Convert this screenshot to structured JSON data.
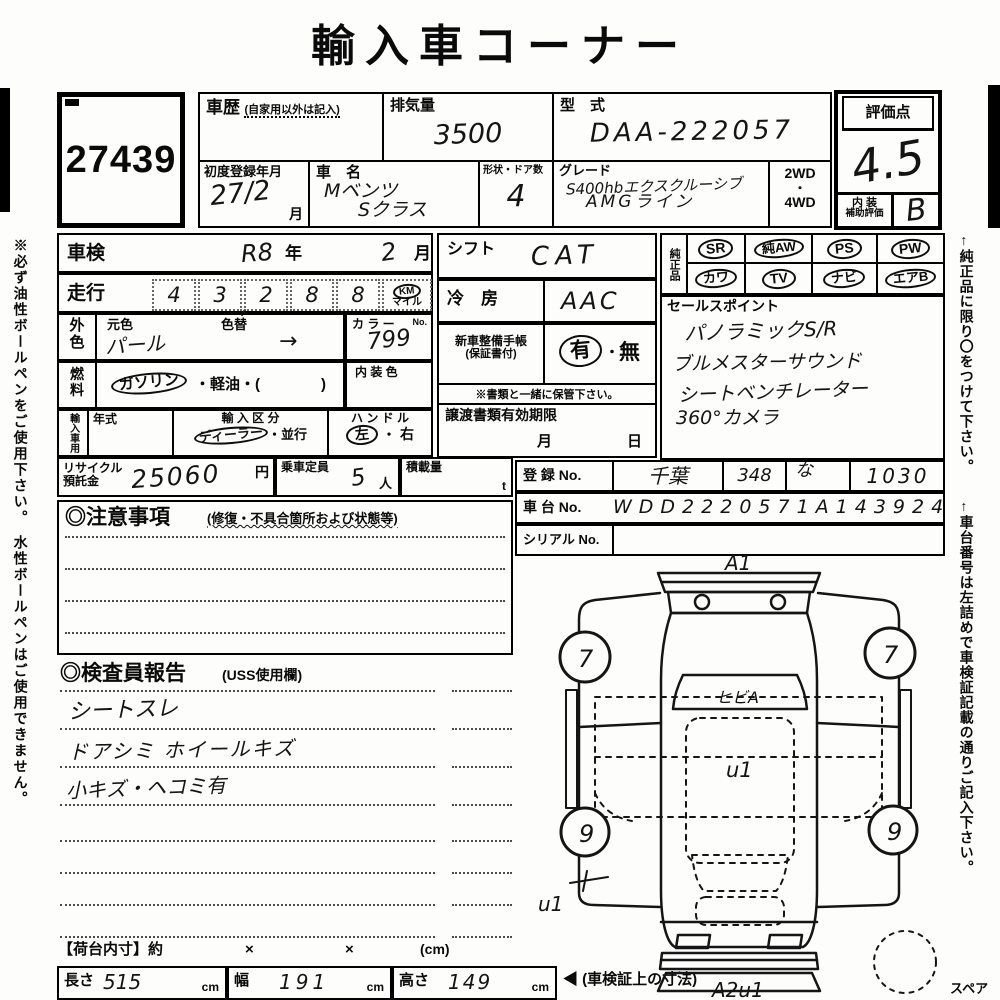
{
  "title": "輸入車コーナー",
  "margin": {
    "left_note": "※必ず油性ボールペンをご使用下さい。　水性ボールペンはご使用できません。",
    "right_note1": "←純正品に限り〇をつけて下さい。",
    "right_note2": "←車台番号は左詰めで車検証記載の通りご記入下さい。",
    "spare": "スペア"
  },
  "lot": {
    "number": "27439"
  },
  "top": {
    "history": {
      "label": "車歴",
      "note": "(自家用以外は記入)"
    },
    "displacement": {
      "label": "排気量",
      "value": "3500"
    },
    "model": {
      "label": "型　式",
      "value": "DAA-222057"
    },
    "first_reg": {
      "label": "初度登録年月",
      "value": "27/2",
      "unit": "月"
    },
    "name": {
      "label": "車　名",
      "line1": "Mベンツ",
      "line2": "Sクラス"
    },
    "doors": {
      "label": "形状・ドア数",
      "value": "4"
    },
    "grade": {
      "label": "グレード",
      "line1": "S400hbエクスクルーシブ",
      "line2": "AMGライン"
    },
    "drive": {
      "l1": "2WD",
      "l2": "・",
      "l3": "4WD"
    }
  },
  "score": {
    "label": "評価点",
    "value": "4.5",
    "int1": "内 装",
    "int2": "補助評価",
    "interior": "B"
  },
  "shaken": {
    "label": "車検",
    "year": "R8",
    "yu": "年",
    "month": "2",
    "mu": "月"
  },
  "mileage": {
    "label": "走行",
    "d": [
      "4",
      "3",
      "2",
      "8",
      "8"
    ],
    "comma": ",",
    "km": "KM",
    "mile": "マイル"
  },
  "color": {
    "v1": "外",
    "v2": "色",
    "base_l": "元色",
    "base": "パール",
    "chg_l": "色替",
    "chg": "→",
    "no_l": "カ ラ ー",
    "no_s": "No.",
    "no": "799"
  },
  "fuel": {
    "v1": "燃",
    "v2": "料",
    "gas": "ガソリン",
    "rest": "・軽油・(",
    "close": ")"
  },
  "intcolor": {
    "label": "内 装 色"
  },
  "imp": {
    "v": "輸入車用",
    "year_l": "年式",
    "kubun_l": "輸 入 区 分",
    "dealer": "ディーラー",
    "kubun_rest": "・並行",
    "handle_l": "ハ ン ド ル",
    "left": "左",
    "sep": "・",
    "right": "右"
  },
  "shift": {
    "label": "シフト",
    "value": "CAT"
  },
  "ac": {
    "label": "冷　房",
    "value": "AAC"
  },
  "book": {
    "l1": "新車整備手帳",
    "l2": "(保証書付)",
    "yes": "有",
    "dot": "・",
    "no": "無",
    "note": "※書類と一緒に保管下さい。"
  },
  "transfer": {
    "label": "譲渡書類有効期限",
    "m": "月",
    "d": "日"
  },
  "equip": {
    "label": "純正品",
    "r1": [
      "SR",
      "純AW",
      "PS",
      "PW"
    ],
    "r2": [
      "カワ",
      "TV",
      "ナビ",
      "エアB"
    ]
  },
  "sales": {
    "label": "セールスポイント",
    "lines": [
      "パノラミックS/R",
      "ブルメスターサウンド",
      "シートベンチレーター",
      "360°カメラ"
    ]
  },
  "reg": {
    "label": "登 録 No.",
    "region": "千葉",
    "cls": "348",
    "kana": "な",
    "num": "1030",
    "chassis_l": "車 台 No.",
    "chassis": "WDD2220571A143924",
    "serial_l": "シリアル No."
  },
  "recycle": {
    "l1": "リサイクル",
    "l2": "預託金",
    "value": "25060",
    "unit": "円"
  },
  "cap": {
    "label": "乗車定員",
    "value": "5",
    "unit": "人"
  },
  "load": {
    "label": "積載量",
    "unit": "t"
  },
  "caution": {
    "header": "◎注意事項",
    "note": "(修復・不具合箇所および状態等)"
  },
  "inspect": {
    "header": "◎検査員報告",
    "note": "(USS使用欄)",
    "lines": [
      "シートスレ",
      "ドアシミ ホイールキズ",
      "小キズ・ヘコミ有"
    ]
  },
  "cargo": {
    "label": "【荷台内寸】約",
    "x1": "×",
    "x2": "×",
    "unit": "(cm)",
    "len_l": "長さ",
    "len": "515",
    "len_u": "cm",
    "wid_l": "幅",
    "wid": "191",
    "wid_u": "cm",
    "hei_l": "高さ",
    "hei": "149",
    "hei_u": "cm",
    "note": "◀ (車検証上の寸法)"
  },
  "diagram": {
    "front": "A1",
    "windshield": "ヒビA",
    "roof": "u1",
    "side": "u1",
    "rear": "A2u1",
    "wfl": "7",
    "wfr": "7",
    "wrl": "9",
    "wrr": "9"
  }
}
